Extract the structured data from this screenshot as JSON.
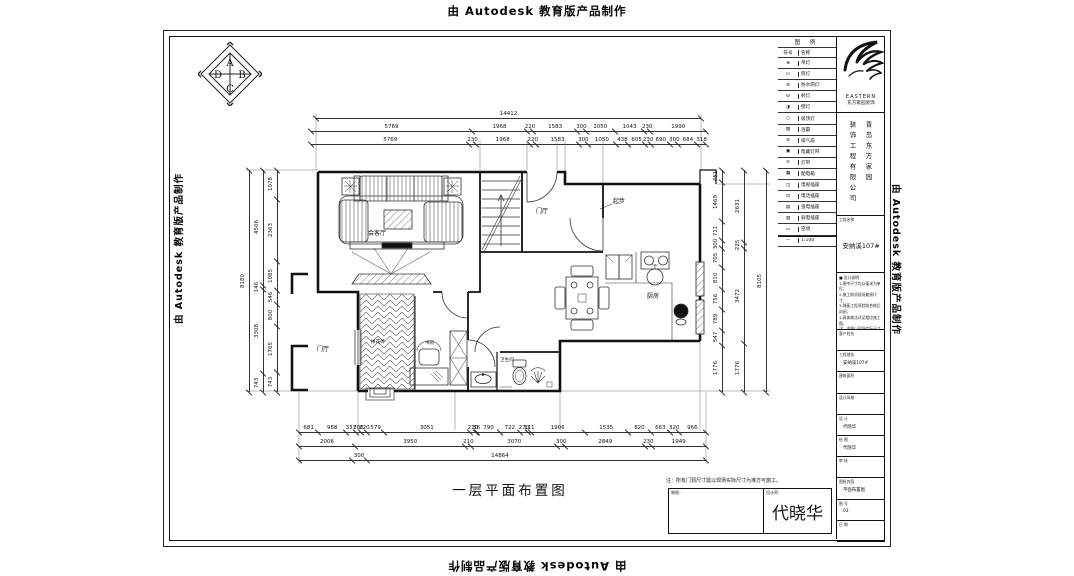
{
  "watermark": {
    "text": "由 Autodesk 教育版产品制作"
  },
  "compass": {
    "top": "A",
    "right": "B",
    "bottom": "C",
    "left": "D"
  },
  "plan": {
    "title": "一层平面布置图",
    "rooms": {
      "living": "会客厅",
      "entry": "门厅",
      "porch": "门厅",
      "kitchen": "厨房",
      "bath": "卫生间",
      "study": "书房",
      "hall_floor": "拼花砖",
      "stair_note": "起步"
    }
  },
  "dims": {
    "top_total": [
      "14412"
    ],
    "top_row2": [
      "5769",
      "1968",
      "220",
      "1583",
      "300",
      "1050",
      "1043",
      "230",
      "1990"
    ],
    "top_row3": [
      "5769",
      "230",
      "1968",
      "220",
      "1583",
      "300",
      "1050",
      "438",
      "605",
      "230",
      "690",
      "300",
      "684",
      "318"
    ],
    "bottom_row1": [
      "681",
      "988",
      "337",
      "200",
      "220",
      "579",
      "3051",
      "210",
      "56",
      "790",
      "722",
      "270",
      "111",
      "1906",
      "1535",
      "820",
      "663",
      "320",
      "966"
    ],
    "bottom_row2": [
      "2006",
      "3950",
      "210",
      "3070",
      "300",
      "2849",
      "230",
      "1949"
    ],
    "bottom_small": "300",
    "bottom_total": "14864",
    "left_outer": [
      "8180"
    ],
    "left_mid": [
      "4506",
      "146",
      "3308",
      "743"
    ],
    "left_inner": [
      "1078",
      "2363",
      "1085",
      "546",
      "800",
      "1765",
      "743"
    ],
    "right_inner": [
      "451",
      "1469",
      "711",
      "300",
      "705",
      "810",
      "756",
      "789",
      "547",
      "1776"
    ],
    "right_mid": [
      "2631",
      "225",
      "3472",
      "1776"
    ],
    "right_outer": [
      "8105"
    ]
  },
  "titleblock": {
    "legend": {
      "header": "图  例",
      "col1": "符号",
      "col2": "名称",
      "rows": [
        {
          "sym": "⊕",
          "name": "吊灯"
        },
        {
          "sym": "∅",
          "name": "筒灯"
        },
        {
          "sym": "⊘",
          "name": "防水筒灯"
        },
        {
          "sym": "Θ",
          "name": "射灯"
        },
        {
          "sym": "◑",
          "name": "壁灯"
        },
        {
          "sym": "○",
          "name": "吸顶灯"
        },
        {
          "sym": "▨",
          "name": "浴霸"
        },
        {
          "sym": "⊖",
          "name": "排气扇"
        },
        {
          "sym": "▣",
          "name": "暗藏灯带"
        },
        {
          "sym": "≡",
          "name": "灯带"
        },
        {
          "sym": "▦",
          "name": "配电箱"
        },
        {
          "sym": "◫",
          "name": "电视插座"
        },
        {
          "sym": "⊡",
          "name": "电话插座"
        },
        {
          "sym": "▤",
          "name": "强电插座"
        },
        {
          "sym": "▥",
          "name": "弱电插座"
        },
        {
          "sym": "▭",
          "name": "空调"
        },
        {
          "sym": "—",
          "name": "1:100"
        }
      ]
    },
    "brand": {
      "en": "EASTERN",
      "cn": "东方家园装饰"
    },
    "company_col_right": "青岛东方家园",
    "company_col_left": "装饰工程有限公司",
    "project_label": "工程名称",
    "project_value": "安纳溪107#",
    "notes_title": "■ 设计说明：",
    "notes": [
      "1.图中尺寸均以毫米为单位；",
      "2.施工前须现场复核尺寸；",
      "3.隐蔽工程须验收合格后封闭；",
      "4.具体做法详见相应施工图。",
      "注：本图以现场实际尺寸为准。"
    ],
    "fields": [
      {
        "label": "客户姓名",
        "value": ""
      },
      {
        "label": "工程地址",
        "value": "安纳溪107#"
      },
      {
        "label": "建筑面积",
        "value": ""
      },
      {
        "label": "设计风格",
        "value": ""
      },
      {
        "label": "设 计",
        "value": "代晓华"
      },
      {
        "label": "绘 图",
        "value": "代晓华"
      },
      {
        "label": "审 核",
        "value": ""
      },
      {
        "label": "图纸内容",
        "value": "平面布置图"
      },
      {
        "label": "图 号",
        "value": "03"
      },
      {
        "label": "日 期",
        "value": ""
      }
    ]
  },
  "footer": {
    "note": "注：所有门洞尺寸需以现场实际尺寸为准方可施工。",
    "sign_left_label": "制图：",
    "sign_right_label": "设计师：",
    "signature": "代晓华"
  }
}
